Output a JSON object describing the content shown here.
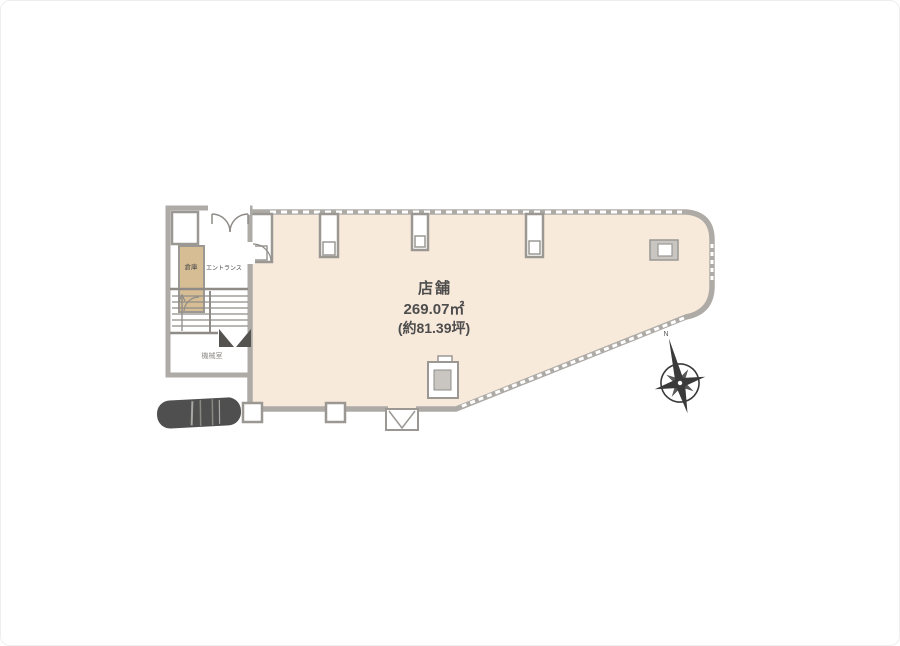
{
  "floorplan": {
    "unit_label": {
      "name": "店舗",
      "area_sqm": "269.07㎡",
      "area_tsubo": "(約81.39坪)"
    },
    "rooms": {
      "storage": "倉庫",
      "entrance": "エントランス",
      "machine_room": "機械室"
    },
    "compass": {
      "north_label": "N"
    },
    "icons": {
      "compass": "compass-rose",
      "car": "car-top-view"
    },
    "colors": {
      "shop_fill": "#f8eadb",
      "storage_fill": "#d7bd94",
      "wall": "#aeaba7",
      "wall_dark": "#8f8c88",
      "wall_light": "#c9c6c2",
      "text": "#4d4d4d",
      "car": "#4f4f4f",
      "compass": "#3a3a3a"
    }
  }
}
